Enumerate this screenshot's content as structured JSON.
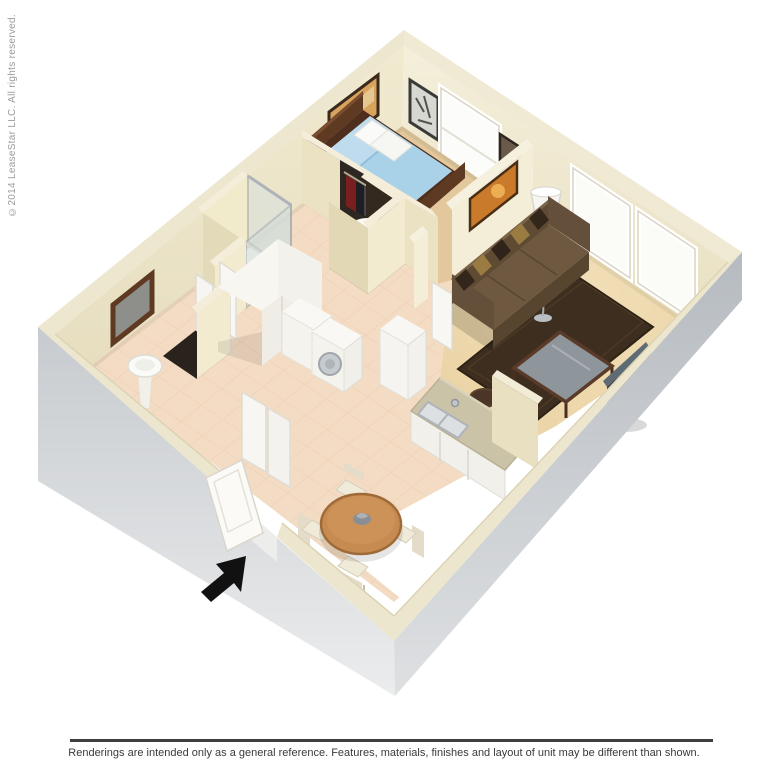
{
  "watermark": {
    "text": "©2014 LeaseStar LLC. All rights reserved."
  },
  "footer": {
    "disclaimer": "Renderings are intended only as a general reference. Features, materials, finishes and layout of unit may be different than shown.",
    "rule_color": "#3F3F3F",
    "text_color": "#3A3A3A"
  },
  "scene": {
    "type": "3d-floor-plan-rendering",
    "rooms": [
      {
        "name": "bedroom",
        "furniture": [
          "double-bed",
          "closet-with-clothes",
          "wall-art",
          "window"
        ]
      },
      {
        "name": "living-room",
        "furniture": [
          "sofa",
          "area-rug",
          "coffee-table",
          "tv",
          "floor-lamp",
          "wall-art",
          "window",
          "window"
        ]
      },
      {
        "name": "bathroom",
        "furniture": [
          "mirror",
          "pedestal-sink",
          "toilet",
          "shower"
        ]
      },
      {
        "name": "hallway",
        "furniture": [
          "wardrobe",
          "washer",
          "dryer",
          "water-heater",
          "linen-closet"
        ]
      },
      {
        "name": "kitchen",
        "furniture": [
          "counter-with-double-sink",
          "bar-stool",
          "bar-stool",
          "refrigerator"
        ]
      },
      {
        "name": "dining-area",
        "furniture": [
          "round-table",
          "chair",
          "chair",
          "chair",
          "chair"
        ]
      }
    ],
    "entry_marker": "black-arrow"
  },
  "palette": {
    "background": "#FFFFFF",
    "wall_top_cream": "#F0EAD3",
    "wall_inner_lit": "#F4EED8",
    "wall_inner_shade": "#EBE2C4",
    "outer_wall_gray": "#C9CDD1",
    "carpet_bedroom": "#E2C89C",
    "carpet_living": "#EDD7AB",
    "tile_floor": "#F3DCC3",
    "bed_blue": "#AFD6EC",
    "sofa_brown": "#6E5940",
    "rug_brown": "#3D2E1F",
    "wood_dark": "#5E3A22",
    "dining_wood": "#C68B50",
    "arrow_black": "#111111",
    "watermark_gray": "#9B9B9B"
  }
}
